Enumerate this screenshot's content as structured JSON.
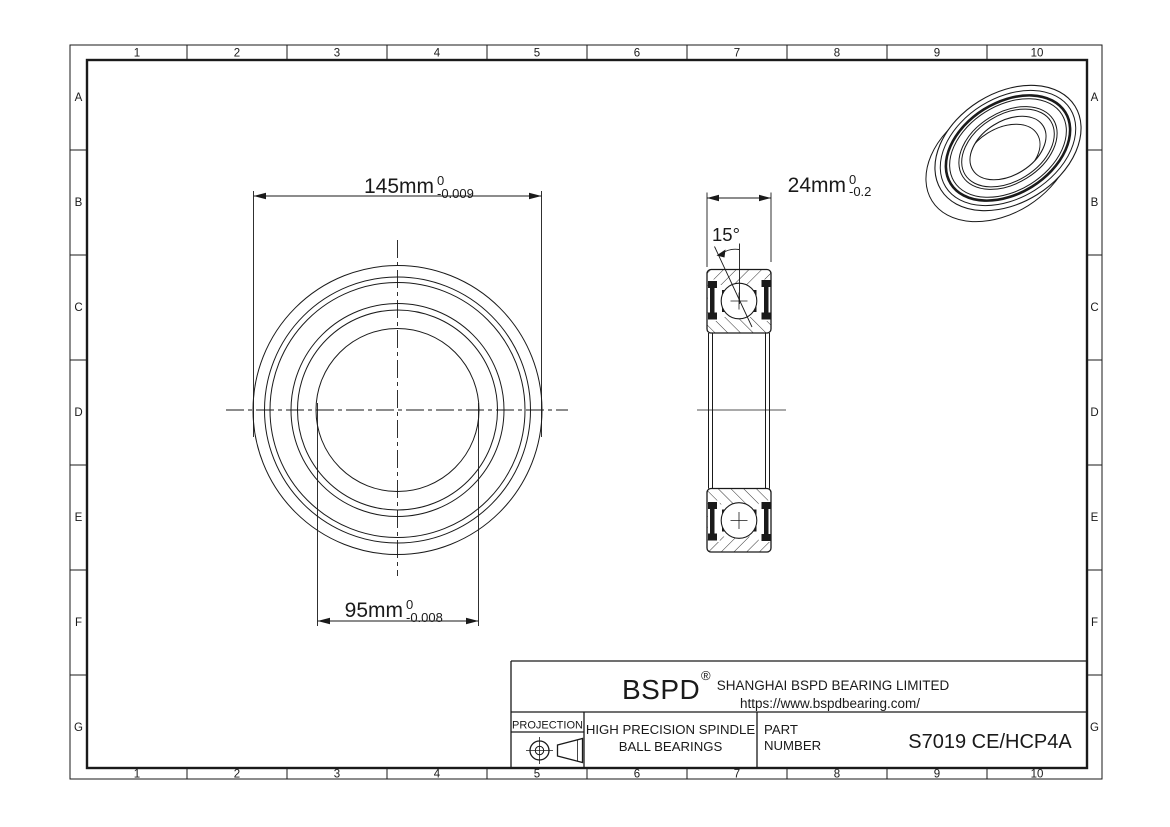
{
  "colors": {
    "line": "#1a1a1a",
    "background": "#ffffff"
  },
  "grid": {
    "columns": [
      "1",
      "2",
      "3",
      "4",
      "5",
      "6",
      "7",
      "8",
      "9",
      "10"
    ],
    "rows": [
      "A",
      "B",
      "C",
      "D",
      "E",
      "F",
      "G"
    ]
  },
  "dimensions": {
    "outer_diameter": {
      "value": "145mm",
      "tol_upper": "0",
      "tol_lower": "-0.009"
    },
    "bore_diameter": {
      "value": "95mm",
      "tol_upper": "0",
      "tol_lower": "-0.008"
    },
    "width": {
      "value": "24mm",
      "tol_upper": "0",
      "tol_lower": "-0.2"
    },
    "contact_angle": {
      "value": "15°"
    }
  },
  "title_block": {
    "logo": "BSPD",
    "registered_mark": "®",
    "company_name": "SHANGHAI BSPD BEARING LIMITED",
    "website": "https://www.bspdbearing.com/",
    "projection_label": "PROJECTION",
    "product_line1": "HIGH  PRECISION SPINDLE",
    "product_line2": "BALL BEARINGS",
    "part_number_label1": "PART",
    "part_number_label2": "NUMBER",
    "part_number": "S7019 CE/HCP4A"
  },
  "icons": {
    "projection_symbol": "projection-angle-icon"
  }
}
